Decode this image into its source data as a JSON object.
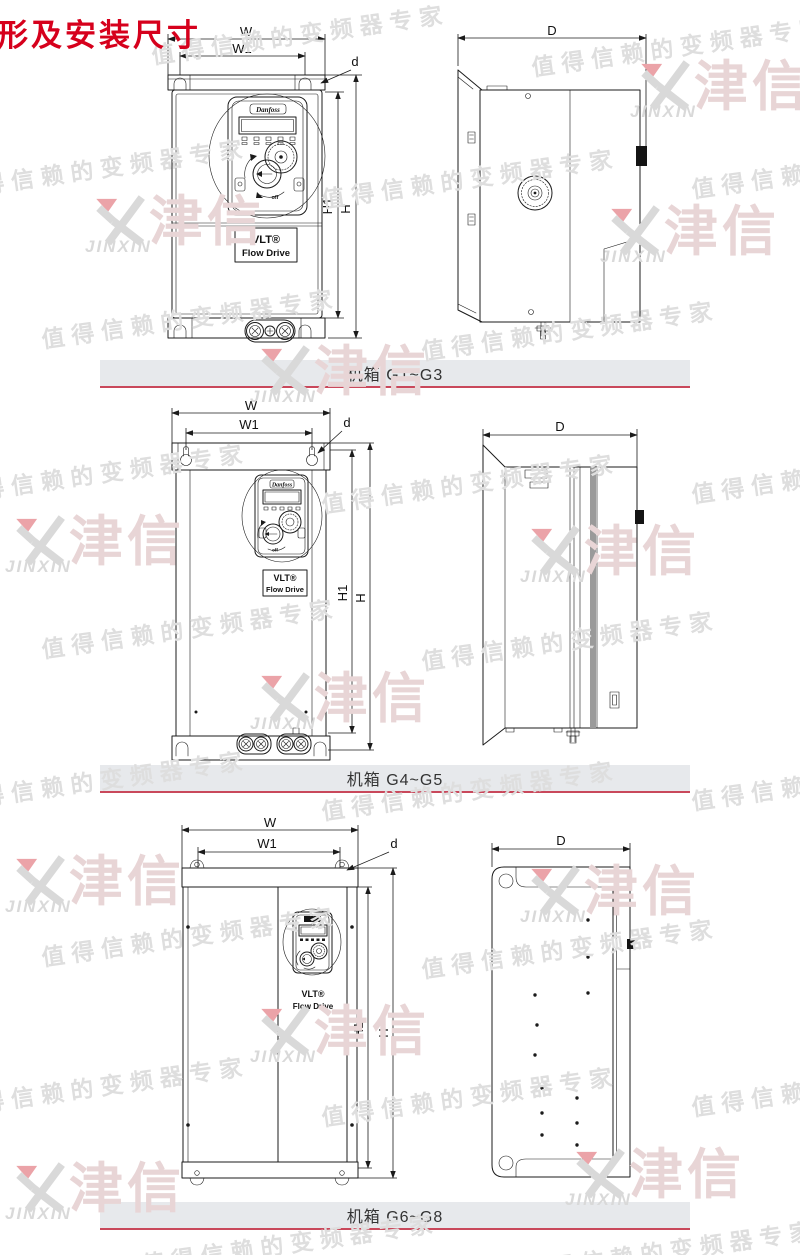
{
  "page": {
    "title": "形及安装尺寸"
  },
  "colors": {
    "accent_red": "#d6001c",
    "caption_rule": "#c9485b",
    "caption_bg": "#e7e9ec",
    "line": "#1b1b1b",
    "watermark_gray": "#dedede",
    "watermark_pink": "#e8d5d6",
    "watermark_logo": "#d9d9d9",
    "watermark_red": "#eba3a8"
  },
  "watermark": {
    "slogan": "值得信赖的变频器专家",
    "brand_cn": "津信",
    "brand_en": "JINXIN"
  },
  "device": {
    "brand": "Danfoss",
    "product_line1": "VLT®",
    "product_line2": "Flow Drive",
    "dial_off": "off"
  },
  "sections": [
    {
      "caption": "机箱 G1~G3",
      "dims": {
        "width": "W",
        "width_inner": "W1",
        "mount_hole": "d",
        "height_inner": "H1",
        "height": "H",
        "depth": "D"
      }
    },
    {
      "caption": "机箱 G4~G5",
      "dims": {
        "width": "W",
        "width_inner": "W1",
        "mount_hole": "d",
        "height_inner": "H1",
        "height": "H",
        "depth": "D"
      }
    },
    {
      "caption": "机箱 G6~G8",
      "dims": {
        "width": "W",
        "width_inner": "W1",
        "mount_hole": "d",
        "height_inner": "H1",
        "height": "H",
        "depth": "D"
      }
    }
  ]
}
